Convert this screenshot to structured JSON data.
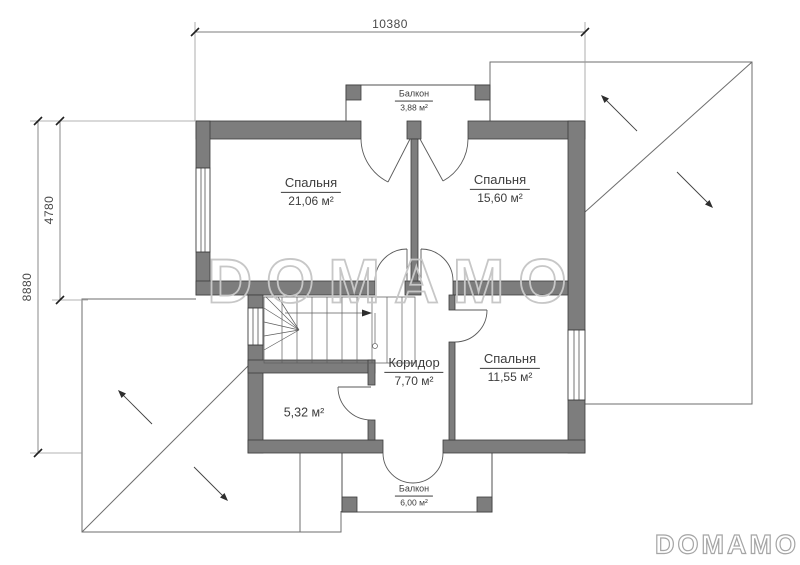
{
  "dimensions": {
    "width_top": "10380",
    "height_upper": "4780",
    "height_total": "8880"
  },
  "rooms": {
    "bedroom1": {
      "name": "Спальня",
      "area": "21,06 м²"
    },
    "bedroom2": {
      "name": "Спальня",
      "area": "15,60 м²"
    },
    "bedroom3": {
      "name": "Спальня",
      "area": "11,55 м²"
    },
    "corridor": {
      "name": "Коридор",
      "area": "7,70 м²"
    },
    "storage": {
      "area": "5,32 м²"
    },
    "balcony_top": {
      "name": "Балкон",
      "area": "3,88 м²"
    },
    "balcony_bottom": {
      "name": "Балкон",
      "area": "6,00 м²"
    }
  },
  "watermark": {
    "center": "DOMAMO",
    "corner": "DOMAMO"
  },
  "colors": {
    "wall": "#7d7d7d",
    "line": "#4f4f4f",
    "dim": "#7c7c7c",
    "watermark": "#c7c7c7"
  }
}
